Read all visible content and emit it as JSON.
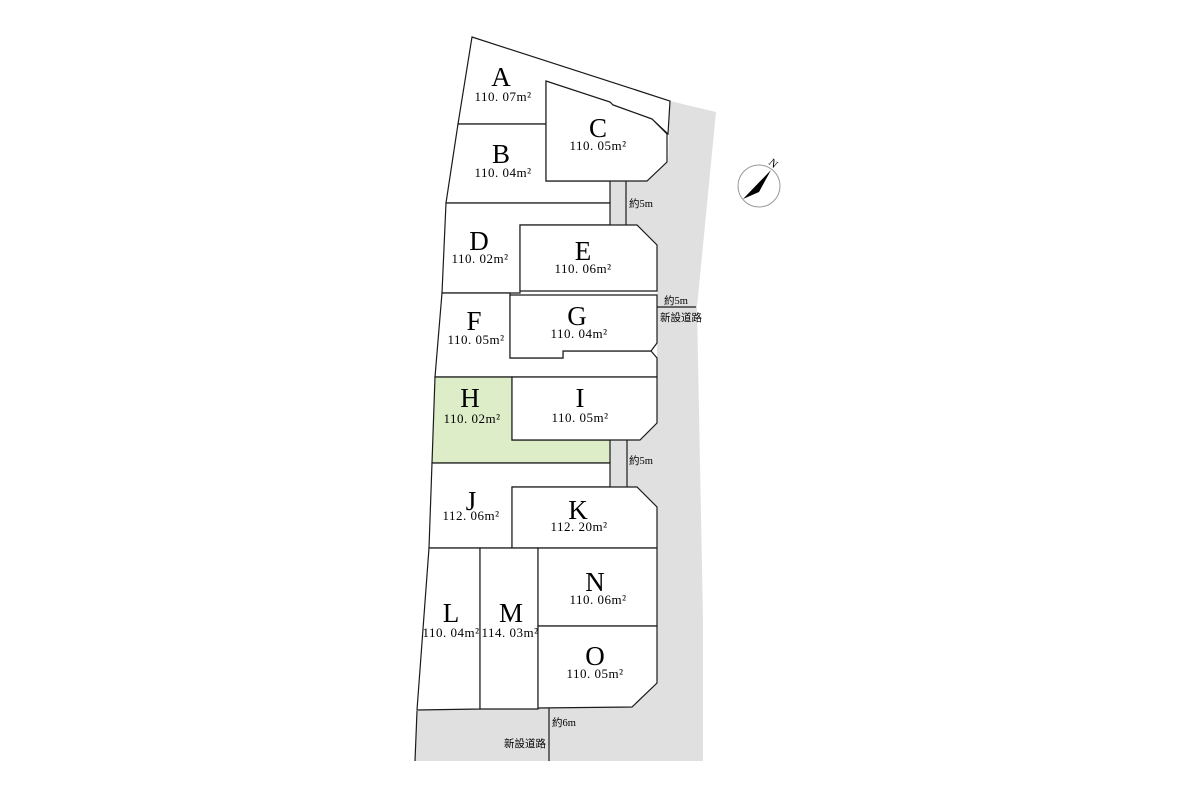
{
  "map": {
    "width": 1200,
    "height": 800,
    "background_color": "#ffffff",
    "road_fill": "#e0e0e0",
    "lot_fill": "#ffffff",
    "highlight_fill": "#dcedc8",
    "line_color": "#1a1a1a"
  },
  "lots": [
    {
      "id": "A",
      "label": "A",
      "area": "110. 07m²",
      "highlight": false,
      "points": "472,37 670,101 668,134 652,119 613,105 610,102 546,82 546,124 458,124",
      "lx": 501,
      "ly": 86,
      "ax": 503,
      "ay": 101
    },
    {
      "id": "B",
      "label": "B",
      "area": "110. 04m²",
      "highlight": false,
      "points": "458,124 546,124 546,181 610,181 610,203 446,203",
      "lx": 501,
      "ly": 163,
      "ax": 503,
      "ay": 177
    },
    {
      "id": "C",
      "label": "C",
      "area": "110. 05m²",
      "highlight": false,
      "points": "546,81 610,102 613,105 652,119 667,134 667,162 647,181 546,181",
      "lx": 598,
      "ly": 137,
      "ax": 598,
      "ay": 150
    },
    {
      "id": "D",
      "label": "D",
      "area": "110. 02m²",
      "highlight": false,
      "points": "446,203 610,203 610,225 520,225 520,293 442,293",
      "lx": 479,
      "ly": 250,
      "ax": 480,
      "ay": 263
    },
    {
      "id": "E",
      "label": "E",
      "area": "110. 06m²",
      "highlight": false,
      "points": "520,225 637,225 657,245 657,291 520,291",
      "lx": 583,
      "ly": 260,
      "ax": 583,
      "ay": 273
    },
    {
      "id": "F",
      "label": "F",
      "area": "110. 05m²",
      "highlight": false,
      "points": "442,293 510,293 510,358 563,358 563,351 651,351 657,358 657,377 435,377",
      "lx": 474,
      "ly": 330,
      "ax": 476,
      "ay": 344
    },
    {
      "id": "G",
      "label": "G",
      "area": "110. 04m²",
      "highlight": false,
      "points": "510,295 657,295 657,343 651,351 563,351 563,358 510,358",
      "lx": 577,
      "ly": 325,
      "ax": 579,
      "ay": 338
    },
    {
      "id": "H",
      "label": "H",
      "area": "110. 02m²",
      "highlight": true,
      "points": "435,377 512,377 512,440 610,440 610,463 432,463",
      "lx": 470,
      "ly": 407,
      "ax": 472,
      "ay": 423
    },
    {
      "id": "I",
      "label": "I",
      "area": "110. 05m²",
      "highlight": false,
      "points": "512,377 657,377 657,423 640,440 512,440",
      "lx": 580,
      "ly": 407,
      "ax": 580,
      "ay": 422
    },
    {
      "id": "J",
      "label": "J",
      "area": "112. 06m²",
      "highlight": false,
      "points": "432,463 610,463 610,487 512,487 512,548 429,548",
      "lx": 471,
      "ly": 510,
      "ax": 471,
      "ay": 520
    },
    {
      "id": "K",
      "label": "K",
      "area": "112. 20m²",
      "highlight": false,
      "points": "512,487 637,487 657,507 657,548 512,548",
      "lx": 578,
      "ly": 519,
      "ax": 579,
      "ay": 531
    },
    {
      "id": "L",
      "label": "L",
      "area": "110. 04m²",
      "highlight": false,
      "points": "429,548 480,548 480,709 417,710",
      "lx": 451,
      "ly": 622,
      "ax": 451,
      "ay": 637
    },
    {
      "id": "M",
      "label": "M",
      "area": "114. 03m²",
      "highlight": false,
      "points": "480,548 538,548 538,709 480,709",
      "lx": 511,
      "ly": 622,
      "ax": 510,
      "ay": 637
    },
    {
      "id": "N",
      "label": "N",
      "area": "110. 06m²",
      "highlight": false,
      "points": "538,548 657,548 657,626 538,626",
      "lx": 595,
      "ly": 591,
      "ax": 598,
      "ay": 604
    },
    {
      "id": "O",
      "label": "O",
      "area": "110. 05m²",
      "highlight": false,
      "points": "538,626 657,626 657,683 632,707 538,708",
      "lx": 595,
      "ly": 665,
      "ax": 595,
      "ay": 678
    }
  ],
  "roads": {
    "polygon": "670,101 716,112 697,307 703,620 703,761 415,761 417,711 432,708 632,707 657,683 657,548 657,507 637,487 610,487 610,440 640,440 657,423 657,245 637,225 610,225 610,181 647,181 668,162",
    "segments": [
      {
        "name": "north-corridor-east-edge",
        "x1": 626,
        "y1": 181,
        "x2": 626,
        "y2": 225
      },
      {
        "name": "south-corridor-east-edge",
        "x1": 627,
        "y1": 440,
        "x2": 627,
        "y2": 487
      },
      {
        "name": "east-road-width-line",
        "x1": 657,
        "y1": 307,
        "x2": 696,
        "y2": 307
      },
      {
        "name": "south-road-width-line",
        "x1": 549,
        "y1": 708,
        "x2": 549,
        "y2": 761
      },
      {
        "name": "south-road-west-edge",
        "x1": 417,
        "y1": 711,
        "x2": 415,
        "y2": 761
      }
    ],
    "labels": [
      {
        "name": "north-corridor-width",
        "text": "約5m",
        "x": 629,
        "y": 207,
        "anchor": "start"
      },
      {
        "name": "east-road-width",
        "text": "約5m",
        "x": 676,
        "y": 304,
        "anchor": "middle"
      },
      {
        "name": "east-road-name",
        "text": "新設道路",
        "x": 681,
        "y": 321,
        "anchor": "middle"
      },
      {
        "name": "south-corridor-width",
        "text": "約5m",
        "x": 629,
        "y": 464,
        "anchor": "start"
      },
      {
        "name": "south-road-width",
        "text": "約6m",
        "x": 552,
        "y": 726,
        "anchor": "start"
      },
      {
        "name": "south-road-name",
        "text": "新設道路",
        "x": 546,
        "y": 747,
        "anchor": "end"
      }
    ]
  },
  "compass": {
    "label": "N",
    "cx": 759,
    "cy": 186,
    "r": 21,
    "needle_points": "771,170 743,199 759,192",
    "label_x": 771,
    "label_y": 166,
    "label_rotation": 40,
    "circle_color": "#999999",
    "needle_color": "#000000"
  }
}
